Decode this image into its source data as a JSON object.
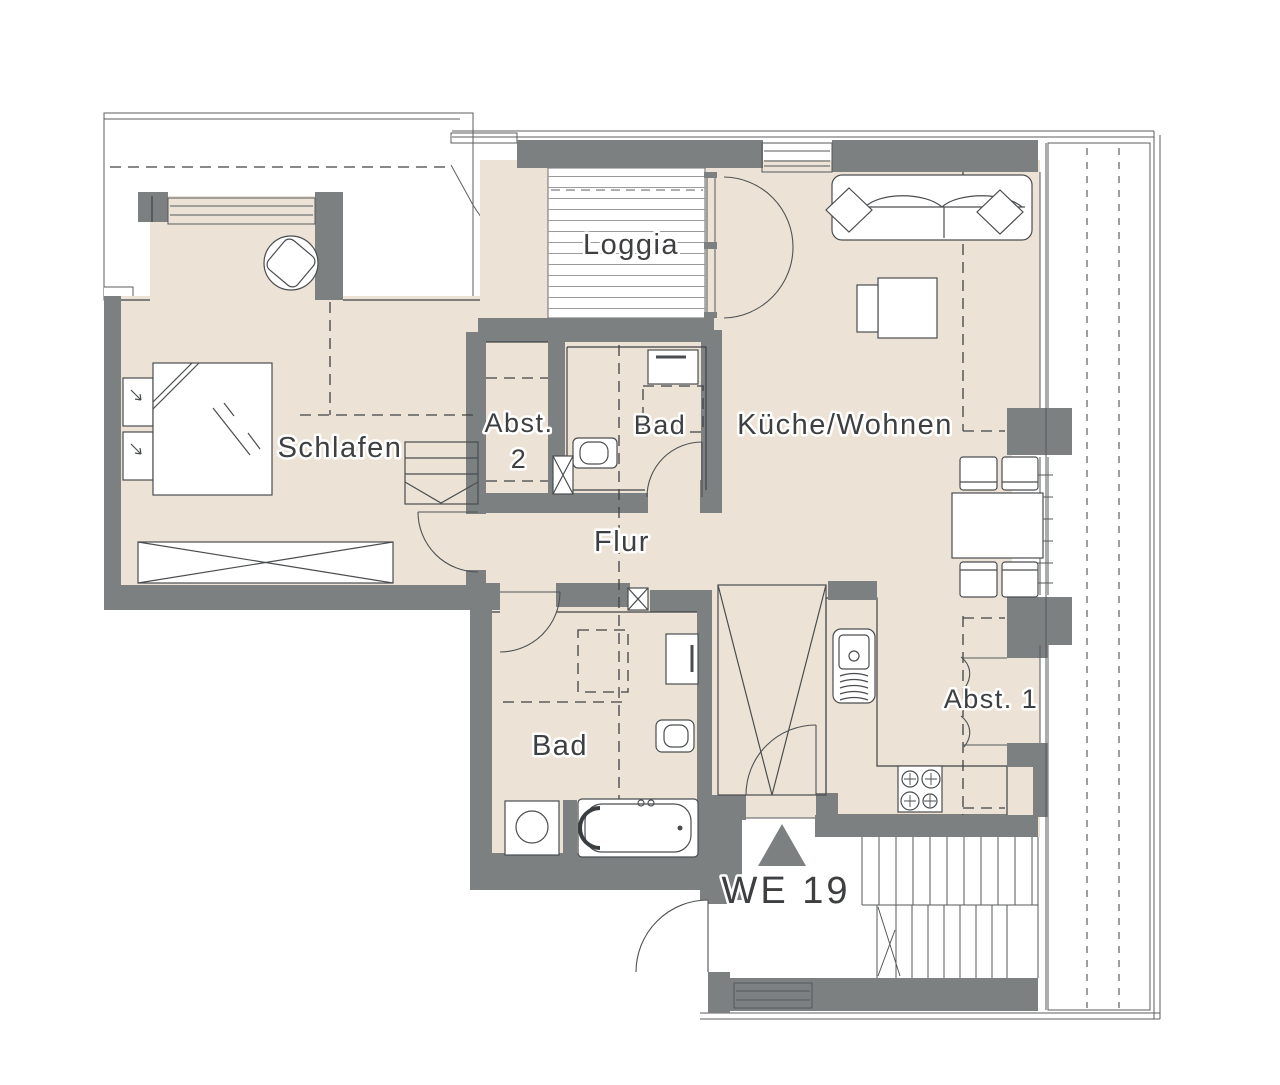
{
  "plan": {
    "title": "WE 19",
    "labels": {
      "loggia": "Loggia",
      "schlafen": "Schlafen",
      "abst2_line1": "Abst.",
      "abst2_line2": "2",
      "bad_upper": "Bad",
      "kueche_wohnen": "Küche/Wohnen",
      "flur": "Flur",
      "bad_lower": "Bad",
      "abst1": "Abst. 1",
      "unit": "WE 19"
    },
    "colors": {
      "wall": "#7d8081",
      "floor": "#ece3d6",
      "line": "#3f4245",
      "hatch": "#6e6e6e",
      "entrance_marker": "#7d8081"
    }
  }
}
